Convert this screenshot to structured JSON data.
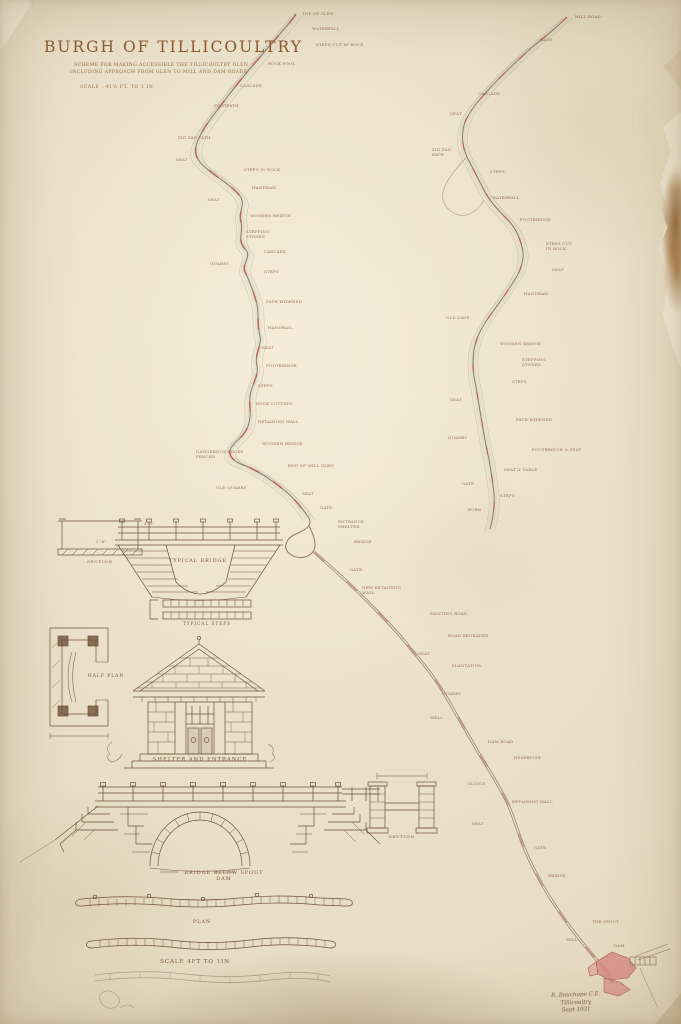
{
  "document": {
    "title": "BURGH OF TILLICOULTRY",
    "subtitle_line1": "SCHEME FOR MAKING ACCESSIBLE THE TILLICOULTRY GLEN",
    "subtitle_line2": "INCLUDING APPROACH FROM GLEN TO MILL AND DAM ROADS",
    "scale_note": "SCALE : 41⅔ FT. TO 1 IN."
  },
  "colors": {
    "paper": "#e8ddc5",
    "ink": "#6f5238",
    "lettering": "#8a5a30",
    "path_red": "#c2584a",
    "stream_wash": "#c2cdc2",
    "stain_brown": "#8a5a20",
    "buildings_pink": "#d4847c"
  },
  "drawings": {
    "section_detail": {
      "label": "SECTION"
    },
    "typical_bridge": {
      "label": "TYPICAL BRIDGE"
    },
    "typical_steps": {
      "label": "TYPICAL STEPS"
    },
    "half_plan": {
      "label": "HALF PLAN"
    },
    "shelter": {
      "label": "SHELTER AND ENTRANCE"
    },
    "bridge_below": {
      "label": "BRIDGE BELOW SPOUT\nDAM"
    },
    "pier_section": {
      "label": "SECTION"
    },
    "plan_strip": {
      "label": "PLAN"
    },
    "plan_scale": {
      "label": "SCALE 4FT TO 1IN"
    }
  },
  "signature": {
    "line1": "R. Bauchope C.E.",
    "line2": "Tillicoultry",
    "line3": "Sept 1931"
  },
  "map": {
    "annotations": [
      {
        "x": 302,
        "y": 12,
        "t": "TOP OF GLEN"
      },
      {
        "x": 312,
        "y": 27,
        "t": "WATERFALL"
      },
      {
        "x": 316,
        "y": 43,
        "t": "STEPS CUT IN ROCK"
      },
      {
        "x": 268,
        "y": 62,
        "t": "ROCK POOL"
      },
      {
        "x": 240,
        "y": 84,
        "t": "CASCADE"
      },
      {
        "x": 214,
        "y": 104,
        "t": "FOOTPATH"
      },
      {
        "x": 178,
        "y": 136,
        "t": "ZIG ZAG PATH"
      },
      {
        "x": 176,
        "y": 158,
        "t": "SEAT"
      },
      {
        "x": 244,
        "y": 168,
        "t": "STEPS IN ROCK"
      },
      {
        "x": 252,
        "y": 186,
        "t": "HANDRAIL"
      },
      {
        "x": 208,
        "y": 198,
        "t": "SEAT"
      },
      {
        "x": 250,
        "y": 214,
        "t": "WOODEN BRIDGE"
      },
      {
        "x": 246,
        "y": 230,
        "t": "STEPPING\nSTONES"
      },
      {
        "x": 264,
        "y": 250,
        "t": "CASCADE"
      },
      {
        "x": 210,
        "y": 262,
        "t": "QUARRY"
      },
      {
        "x": 264,
        "y": 270,
        "t": "STEPS"
      },
      {
        "x": 266,
        "y": 300,
        "t": "PATH WIDENED"
      },
      {
        "x": 268,
        "y": 326,
        "t": "HANDRAIL"
      },
      {
        "x": 262,
        "y": 346,
        "t": "SEAT"
      },
      {
        "x": 266,
        "y": 364,
        "t": "FOOTBRIDGE"
      },
      {
        "x": 258,
        "y": 384,
        "t": "STEPS"
      },
      {
        "x": 256,
        "y": 402,
        "t": "ROCK CUTTING"
      },
      {
        "x": 258,
        "y": 420,
        "t": "RETAINING WALL"
      },
      {
        "x": 196,
        "y": 450,
        "t": "DANGEROUS ROCKS\nFENCED"
      },
      {
        "x": 262,
        "y": 442,
        "t": "WOODEN BRIDGE"
      },
      {
        "x": 288,
        "y": 464,
        "t": "END OF MILL GLEN"
      },
      {
        "x": 216,
        "y": 486,
        "t": "OLD QUARRY"
      },
      {
        "x": 302,
        "y": 492,
        "t": "SEAT"
      },
      {
        "x": 320,
        "y": 506,
        "t": "GATE"
      },
      {
        "x": 338,
        "y": 520,
        "t": "ENTRANCE\nSHELTER"
      },
      {
        "x": 354,
        "y": 540,
        "t": "BRIDGE"
      },
      {
        "x": 350,
        "y": 568,
        "t": "GATE"
      },
      {
        "x": 362,
        "y": 586,
        "t": "NEW RETAINING\nWALL"
      },
      {
        "x": 430,
        "y": 612,
        "t": "EXISTING ROAD"
      },
      {
        "x": 448,
        "y": 634,
        "t": "ROAD REGRADED"
      },
      {
        "x": 418,
        "y": 652,
        "t": "SEAT"
      },
      {
        "x": 452,
        "y": 664,
        "t": "PLANTATION"
      },
      {
        "x": 442,
        "y": 692,
        "t": "QUARRY"
      },
      {
        "x": 430,
        "y": 716,
        "t": "WELL"
      },
      {
        "x": 488,
        "y": 740,
        "t": "DAM ROAD"
      },
      {
        "x": 514,
        "y": 756,
        "t": "RESERVOIR"
      },
      {
        "x": 468,
        "y": 782,
        "t": "SLUICE"
      },
      {
        "x": 512,
        "y": 800,
        "t": "RETAINING WALL"
      },
      {
        "x": 472,
        "y": 822,
        "t": "SEAT"
      },
      {
        "x": 534,
        "y": 846,
        "t": "GATE"
      },
      {
        "x": 548,
        "y": 874,
        "t": "BRIDGE"
      },
      {
        "x": 592,
        "y": 920,
        "t": "THE SPOUT"
      },
      {
        "x": 566,
        "y": 938,
        "t": "MILL"
      },
      {
        "x": 614,
        "y": 944,
        "t": "DAM"
      },
      {
        "x": 575,
        "y": 15,
        "t": "HILL ROAD"
      },
      {
        "x": 540,
        "y": 38,
        "t": "GATE"
      },
      {
        "x": 478,
        "y": 92,
        "t": "CASCADE"
      },
      {
        "x": 450,
        "y": 112,
        "t": "SEAT"
      },
      {
        "x": 432,
        "y": 148,
        "t": "ZIG ZAG\nPATH"
      },
      {
        "x": 490,
        "y": 170,
        "t": "STEPS"
      },
      {
        "x": 492,
        "y": 196,
        "t": "WATERFALL"
      },
      {
        "x": 520,
        "y": 218,
        "t": "FOOTBRIDGE"
      },
      {
        "x": 546,
        "y": 242,
        "t": "STEPS CUT\nIN ROCK"
      },
      {
        "x": 552,
        "y": 268,
        "t": "SEAT"
      },
      {
        "x": 524,
        "y": 292,
        "t": "HANDRAIL"
      },
      {
        "x": 446,
        "y": 316,
        "t": "OLD LADE"
      },
      {
        "x": 500,
        "y": 342,
        "t": "WOODEN BRIDGE"
      },
      {
        "x": 522,
        "y": 358,
        "t": "STEPPING\nSTONES"
      },
      {
        "x": 512,
        "y": 380,
        "t": "STEPS"
      },
      {
        "x": 450,
        "y": 398,
        "t": "SEAT"
      },
      {
        "x": 516,
        "y": 418,
        "t": "PATH WIDENED"
      },
      {
        "x": 448,
        "y": 436,
        "t": "QUARRY"
      },
      {
        "x": 532,
        "y": 448,
        "t": "FOOTBRIDGE & SEAT"
      },
      {
        "x": 504,
        "y": 468,
        "t": "SEAT & TABLE"
      },
      {
        "x": 462,
        "y": 482,
        "t": "GATE"
      },
      {
        "x": 500,
        "y": 494,
        "t": "STEPS"
      },
      {
        "x": 468,
        "y": 508,
        "t": "BURN"
      },
      {
        "x": 144,
        "y": 522,
        "t": "4'-0\""
      },
      {
        "x": 96,
        "y": 540,
        "t": "2'-6\""
      }
    ]
  }
}
